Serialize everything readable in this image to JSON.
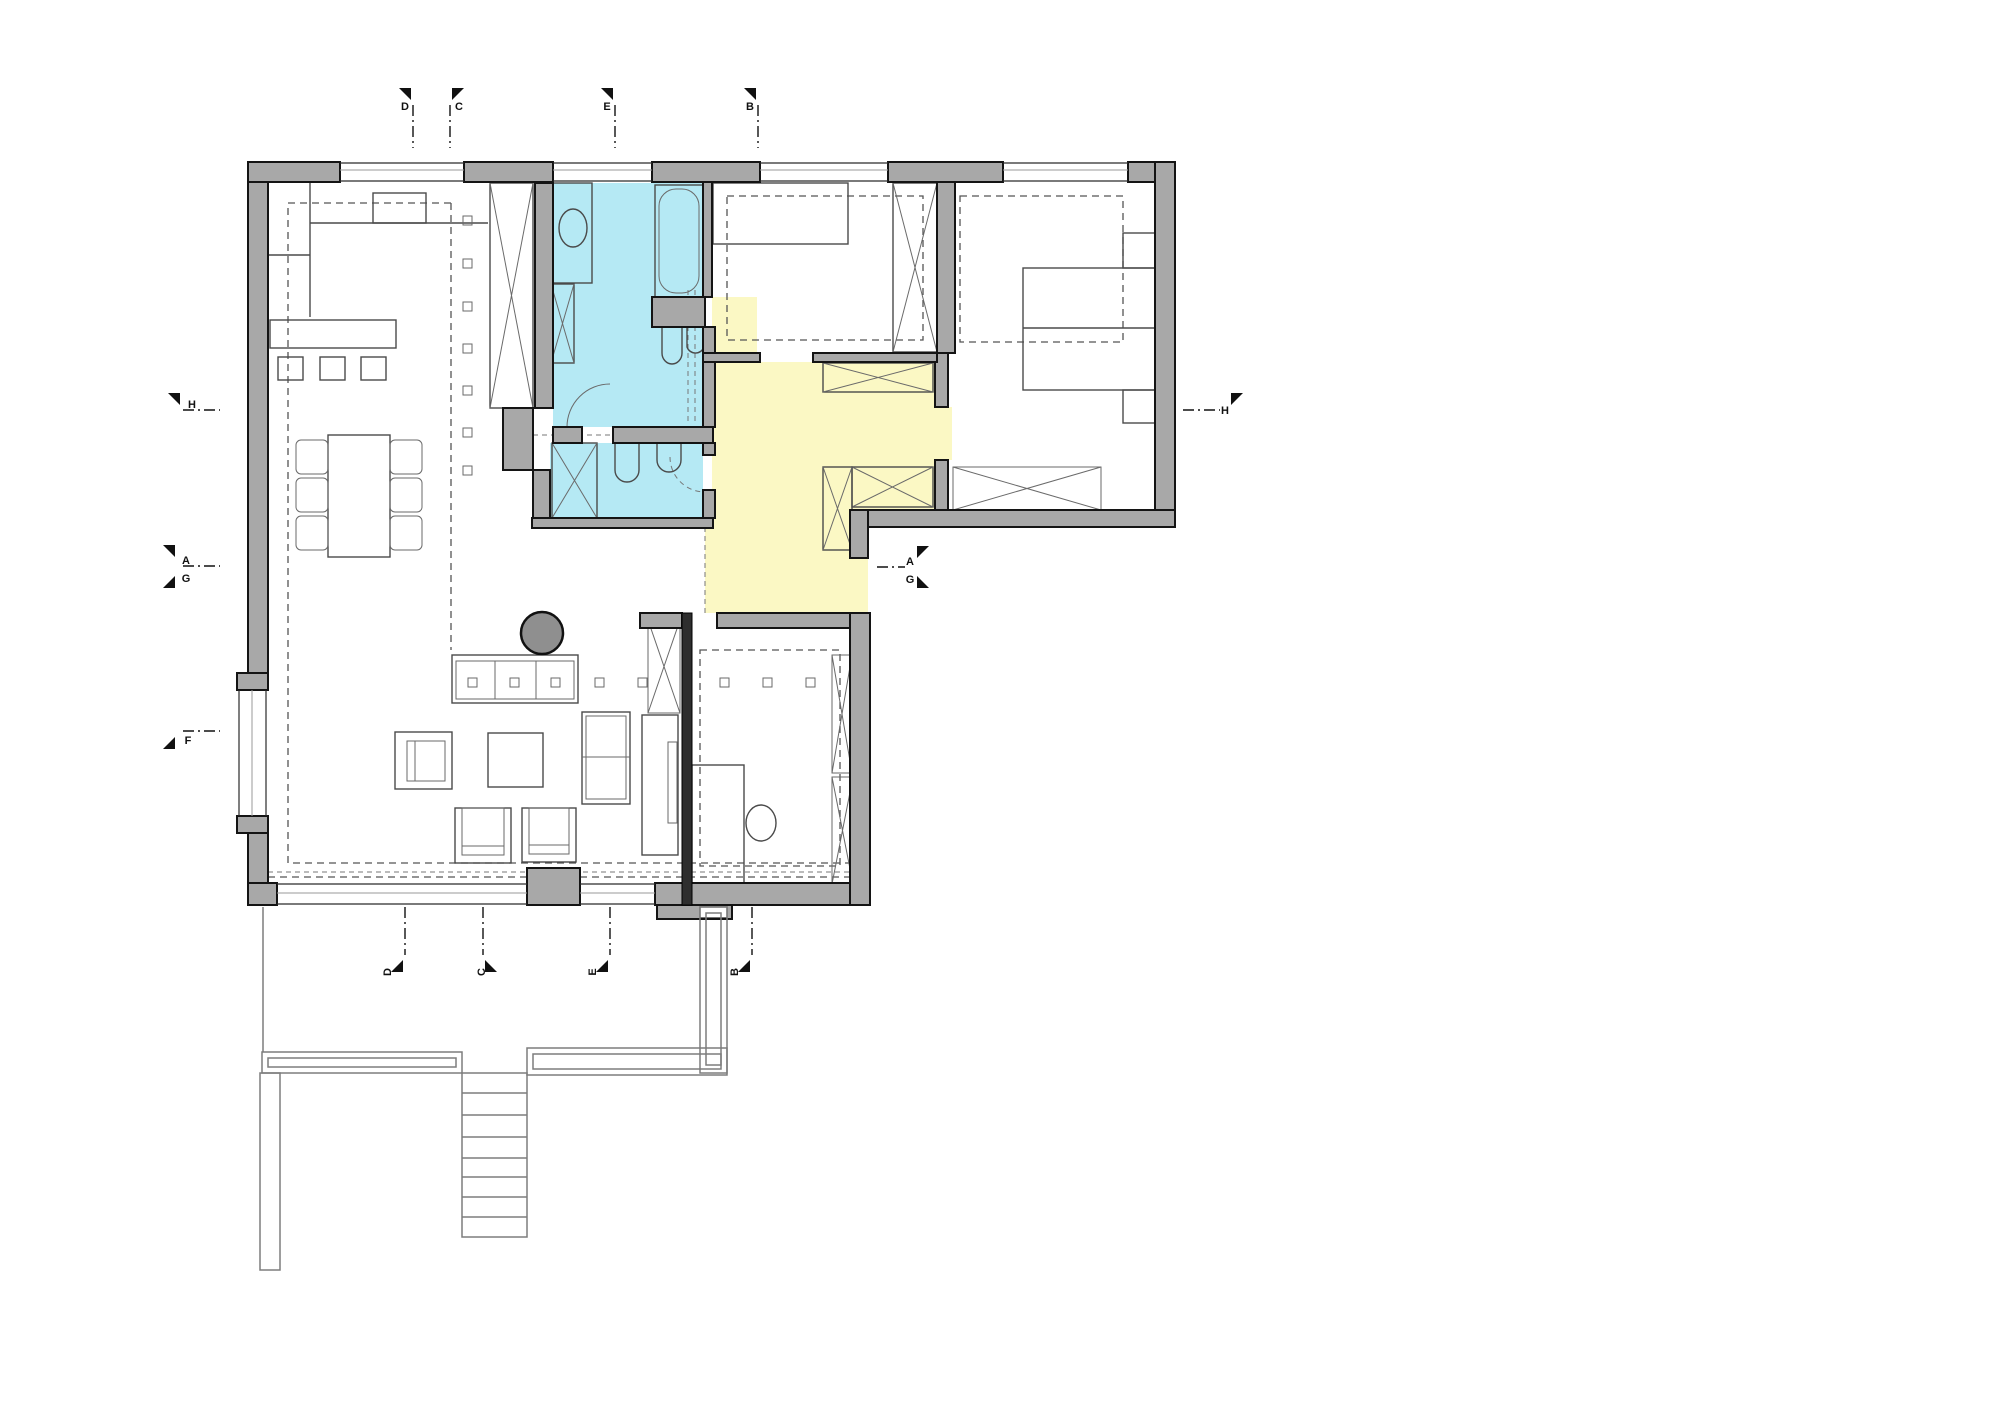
{
  "page": {
    "title": "Ground floor plan with section markers"
  },
  "colors": {
    "wall": "#a8a8a8",
    "partition": "#2e2e2e",
    "bathroom_fill": "#b5e9f4",
    "hall_fill": "#fbf8c4",
    "column_fill": "#8f8f8f"
  },
  "markers": {
    "top": [
      {
        "label": "D"
      },
      {
        "label": "C"
      },
      {
        "label": "E"
      },
      {
        "label": "B"
      }
    ],
    "bottom": [
      {
        "label": "D"
      },
      {
        "label": "C"
      },
      {
        "label": "E"
      },
      {
        "label": "B"
      }
    ],
    "left": [
      {
        "label": "H"
      },
      {
        "label": "A"
      },
      {
        "label": "G"
      },
      {
        "label": "F"
      }
    ],
    "right": [
      {
        "label": "H"
      },
      {
        "label": "A"
      },
      {
        "label": "G"
      }
    ]
  }
}
